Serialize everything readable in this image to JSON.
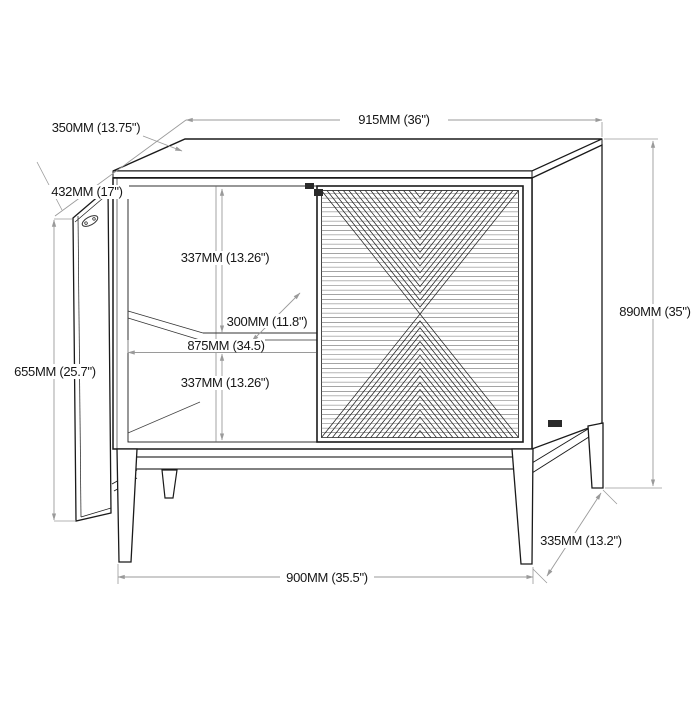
{
  "dims": {
    "top_width": "915MM (36\")",
    "top_depth": "350MM (13.75\")",
    "door_width": "432MM (17\")",
    "door_height": "655MM (25.7\")",
    "overall_height": "890MM (35\")",
    "upper_compartment_height": "337MM (13.26\")",
    "shelf_depth": "300MM (11.8\")",
    "interior_width": "875MM (34.5)",
    "lower_compartment_height": "337MM (13.26\")",
    "base_width": "900MM (35.5\")",
    "base_depth": "335MM (13.2\")"
  },
  "colors": {
    "furniture_line": "#1a1a1a",
    "dimension_line": "#9a9a9a",
    "text": "#161616",
    "background": "#ffffff"
  }
}
